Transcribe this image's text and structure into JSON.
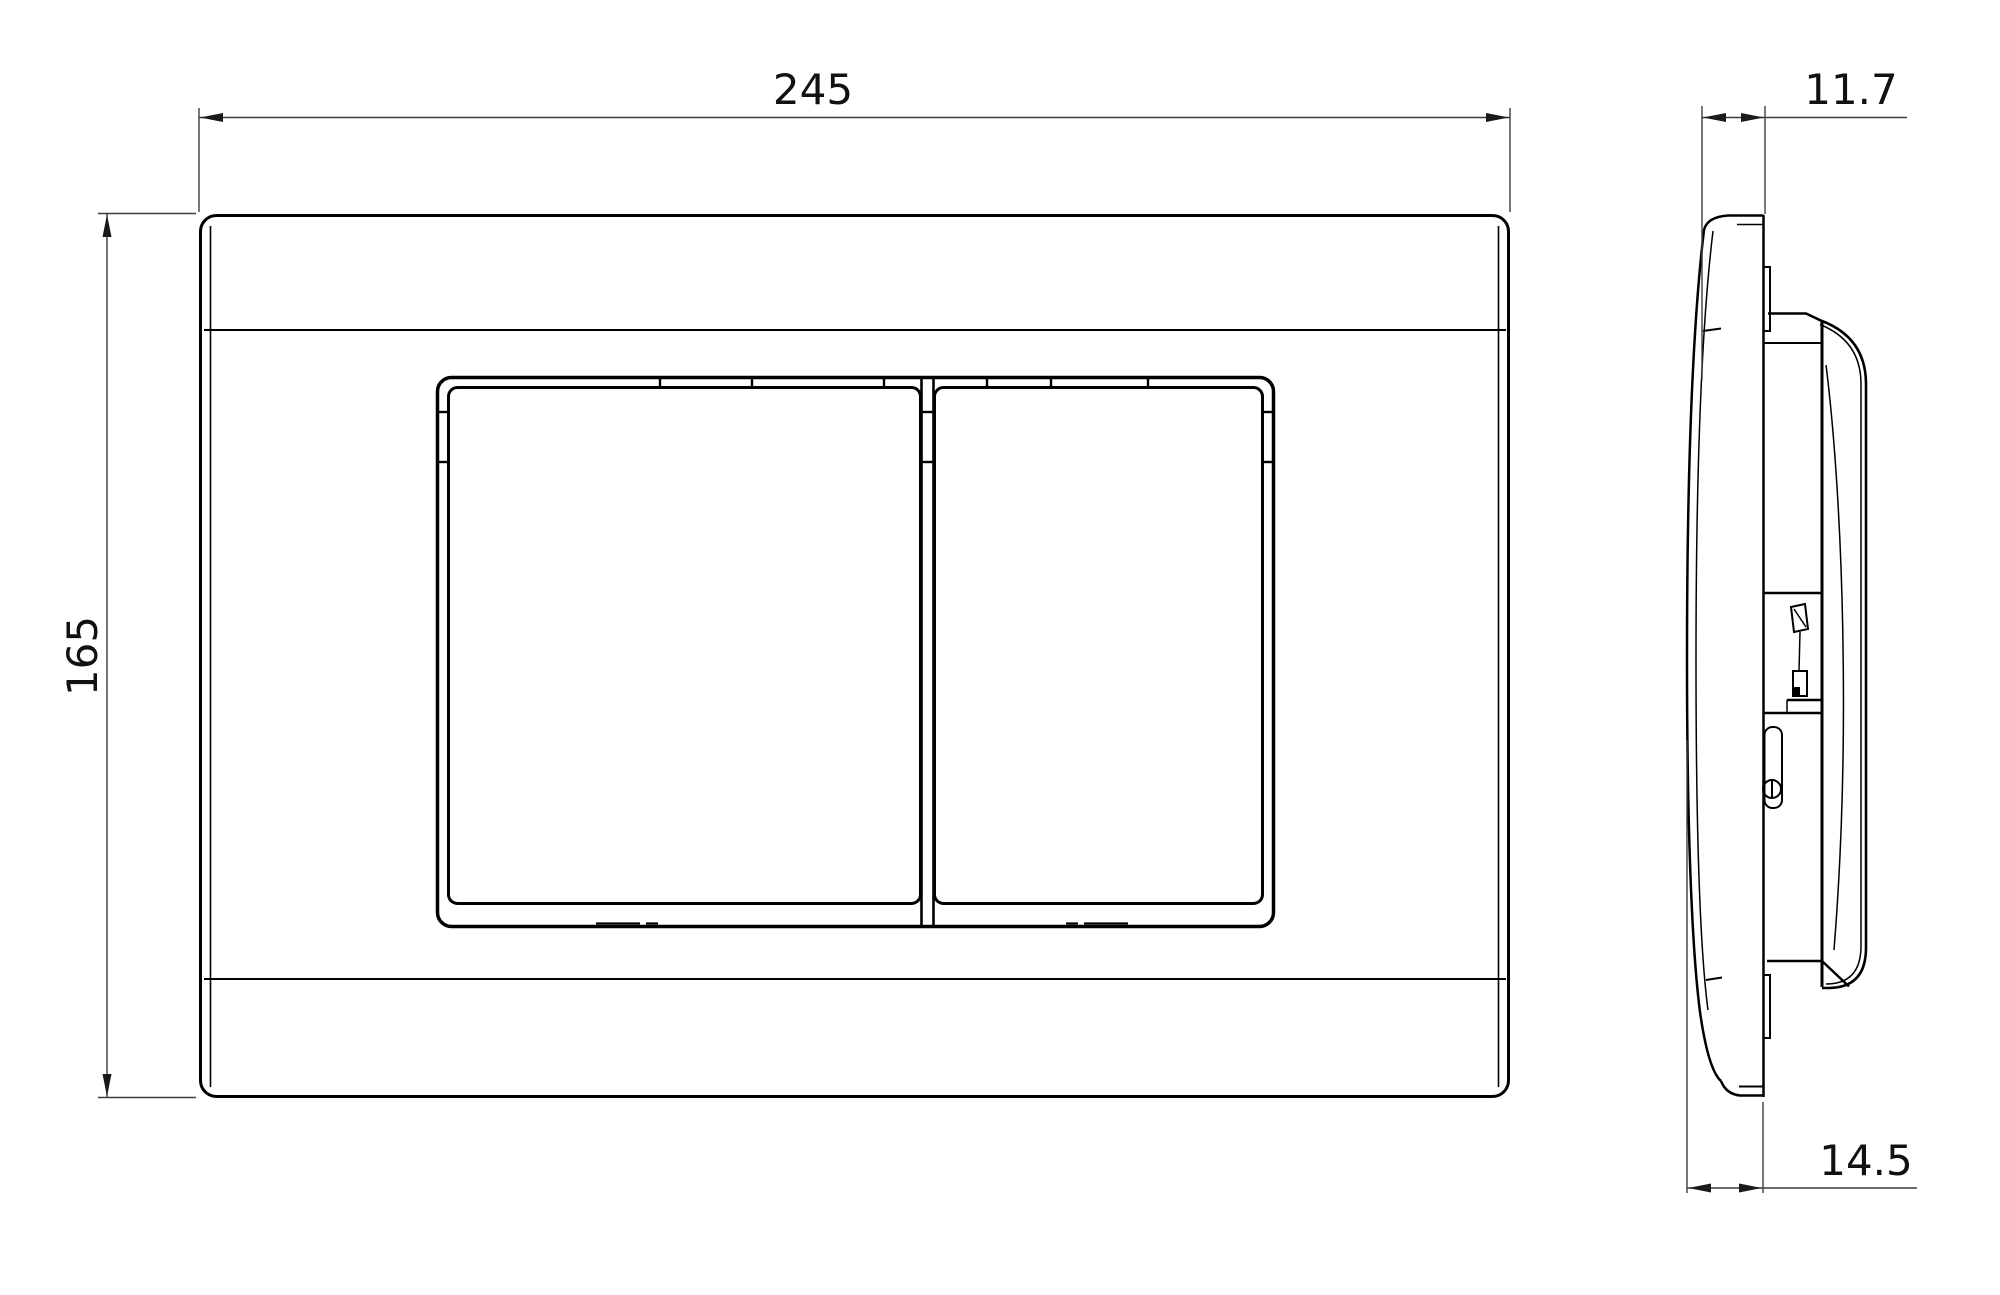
{
  "drawing": {
    "dimensions": {
      "width": "245",
      "height": "165",
      "depth_top": "11.7",
      "depth_bottom": "14.5"
    }
  },
  "colors": {
    "line": "#000000",
    "dimension_line": "#3d3d3d",
    "background": "#ffffff"
  }
}
